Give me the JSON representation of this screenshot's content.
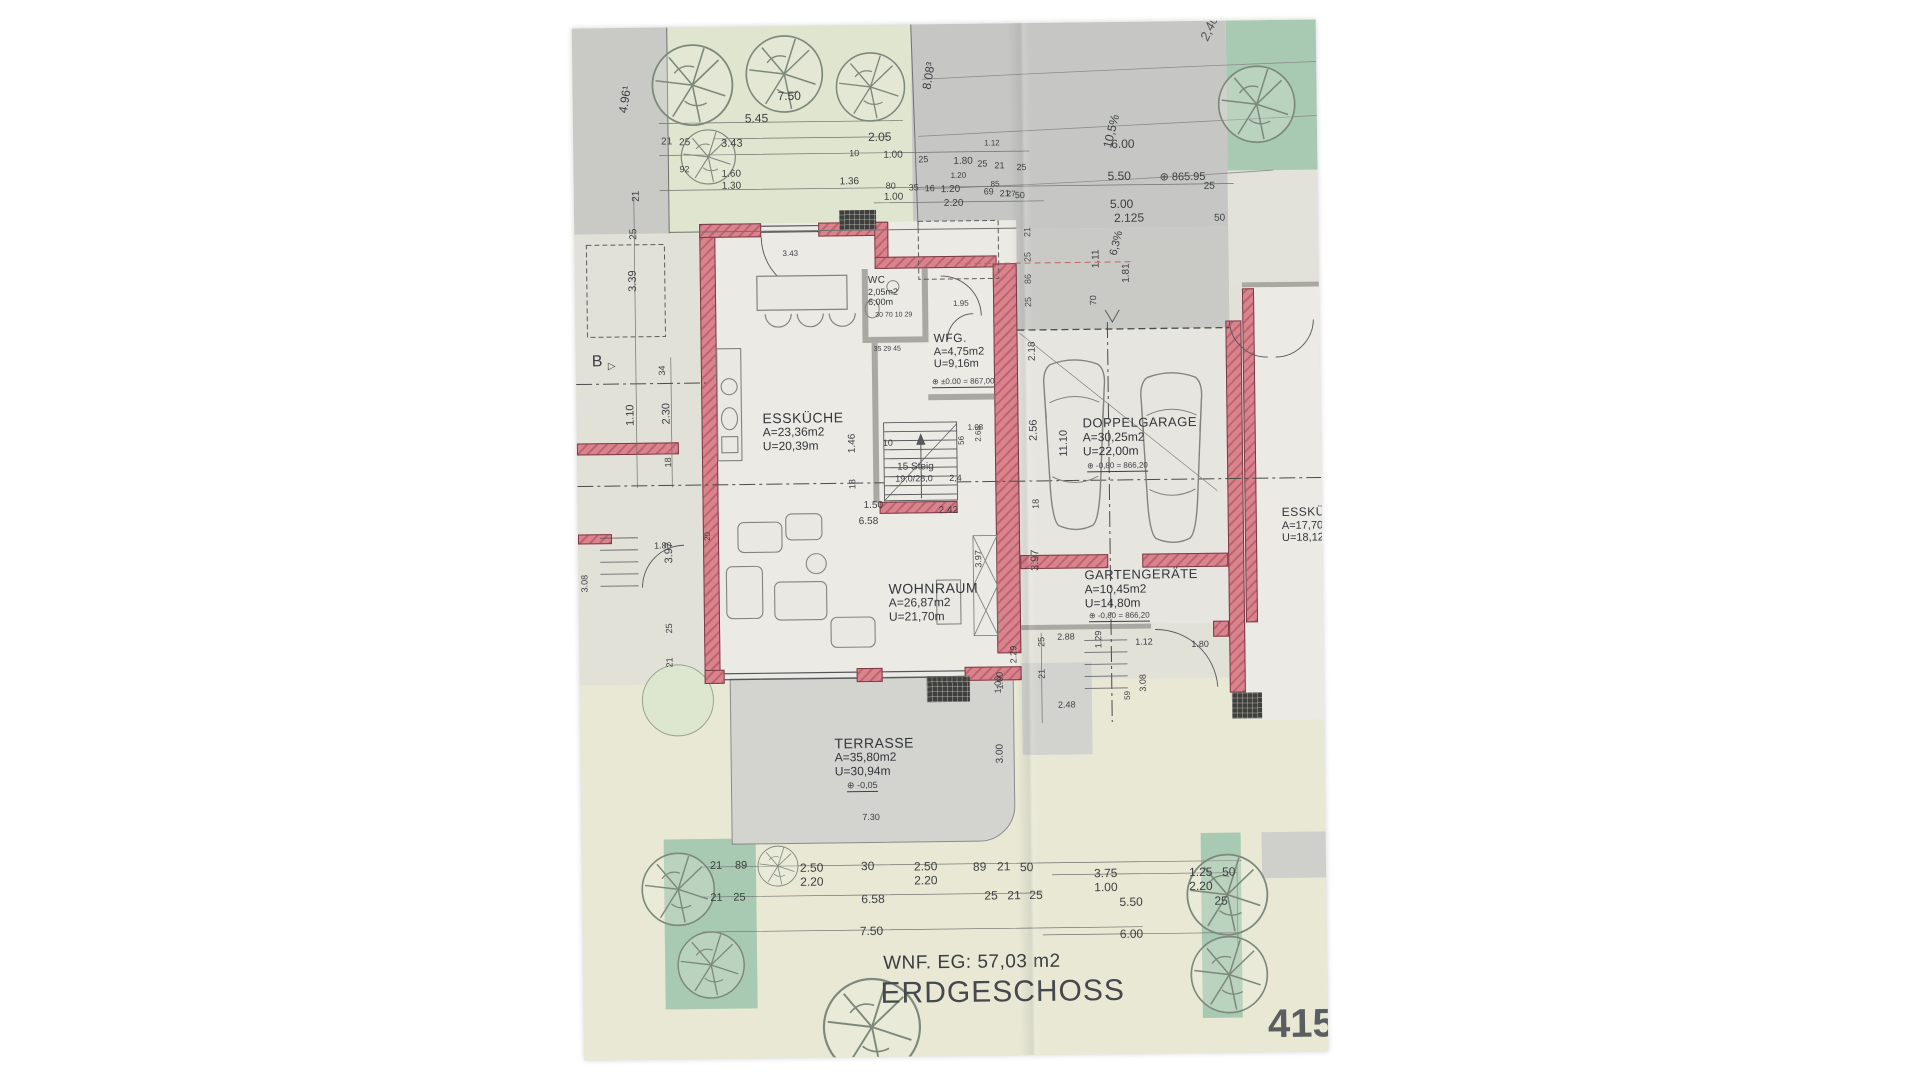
{
  "title_block": {
    "wnf": "WNF. EG: 57,03 m2",
    "floor": "ERDGESCHOSS",
    "sheet": "415"
  },
  "colors": {
    "wall_pink": "#d9838d",
    "paper": "#e2e1d8",
    "street_gray": "#c6c7c5",
    "garden_green": "#e0e5cf",
    "hedge_green": "#a8cab2",
    "terrace_gray": "#d3d3d0",
    "ink": "#3d4043"
  },
  "rooms": [
    {
      "id": "wc",
      "x": 293,
      "y": 250,
      "t": "WC",
      "ts": 10,
      "lines": [
        "2,05m2",
        "6,00m"
      ],
      "ls": 9
    },
    {
      "id": "wfg",
      "x": 358,
      "y": 308,
      "t": "WFG.",
      "ts": 12,
      "lines": [
        "A=4,75m2",
        "U=9,16m"
      ],
      "ls": 11
    },
    {
      "id": "esskueche",
      "x": 186,
      "y": 384,
      "t": "ESSKÜCHE",
      "ts": 14,
      "lines": [
        "A=23,36m2",
        "U=20,39m"
      ],
      "ls": 12
    },
    {
      "id": "wohnraum",
      "x": 310,
      "y": 556,
      "t": "WOHNRAUM",
      "ts": 14,
      "lines": [
        "A=26,87m2",
        "U=21,70m"
      ],
      "ls": 12
    },
    {
      "id": "doppelgarage",
      "x": 506,
      "y": 394,
      "t": "DOPPELGARAGE",
      "ts": 13,
      "lines": [
        "A=30,25m2",
        "U=22,00m"
      ],
      "ls": 12
    },
    {
      "id": "gartengeraete",
      "x": 506,
      "y": 546,
      "t": "GARTENGERÄTE",
      "ts": 13,
      "lines": [
        "A=10,45m2",
        "U=14,80m"
      ],
      "ls": 12
    },
    {
      "id": "terrasse",
      "x": 254,
      "y": 710,
      "t": "TERRASSE",
      "ts": 14,
      "lines": [
        "A=35,80m2",
        "U=30,94m"
      ],
      "ls": 12
    },
    {
      "id": "esskueche-nachbar",
      "x": 704,
      "y": 486,
      "t": "ESSKÜCHE",
      "ts": 12,
      "lines": [
        "A=17,70m2",
        "U=18,12m"
      ],
      "ls": 11
    }
  ],
  "dims": [
    {
      "t": "4.96¹",
      "x": 44,
      "y": 84,
      "r": -80,
      "s": 12
    },
    {
      "t": "7.50",
      "x": 205,
      "y": 64,
      "s": 12
    },
    {
      "t": "5.45",
      "x": 172,
      "y": 86,
      "s": 12
    },
    {
      "t": "3.43",
      "x": 148,
      "y": 112,
      "s": 11
    },
    {
      "t": "21",
      "x": 88,
      "y": 110
    },
    {
      "t": "25",
      "x": 106,
      "y": 111
    },
    {
      "t": "2.05",
      "x": 295,
      "y": 106,
      "s": 12
    },
    {
      "t": "10",
      "x": 276,
      "y": 124,
      "s": 9
    },
    {
      "t": "1.00",
      "x": 310,
      "y": 126
    },
    {
      "t": "25",
      "x": 345,
      "y": 131,
      "s": 9
    },
    {
      "t": "1.80",
      "x": 380,
      "y": 133
    },
    {
      "t": "25",
      "x": 404,
      "y": 136,
      "s": 9
    },
    {
      "t": "21",
      "x": 421,
      "y": 138,
      "s": 9
    },
    {
      "t": "25",
      "x": 443,
      "y": 140,
      "s": 9
    },
    {
      "t": "92",
      "x": 106,
      "y": 138,
      "s": 9
    },
    {
      "t": "1.60",
      "x": 148,
      "y": 143
    },
    {
      "t": "1.30",
      "x": 148,
      "y": 155
    },
    {
      "t": "1.36",
      "x": 266,
      "y": 152
    },
    {
      "t": "80",
      "x": 312,
      "y": 157,
      "s": 9
    },
    {
      "t": "35",
      "x": 335,
      "y": 159,
      "s": 9
    },
    {
      "t": "16",
      "x": 351,
      "y": 160,
      "s": 9
    },
    {
      "t": "1.20",
      "x": 367,
      "y": 161
    },
    {
      "t": "69",
      "x": 410,
      "y": 164,
      "s": 9
    },
    {
      "t": "21",
      "x": 426,
      "y": 166,
      "s": 9
    },
    {
      "t": "50",
      "x": 441,
      "y": 168,
      "s": 9
    },
    {
      "t": "1.00",
      "x": 310,
      "y": 168
    },
    {
      "t": "2.20",
      "x": 370,
      "y": 175
    },
    {
      "t": "6.00",
      "x": 538,
      "y": 116,
      "s": 12
    },
    {
      "t": "5.50",
      "x": 534,
      "y": 148,
      "s": 12
    },
    {
      "t": "⊕ 865.95",
      "x": 586,
      "y": 151,
      "s": 11
    },
    {
      "t": "25",
      "x": 630,
      "y": 161
    },
    {
      "t": "5.00",
      "x": 536,
      "y": 176,
      "s": 12
    },
    {
      "t": "2.125",
      "x": 540,
      "y": 190,
      "s": 12
    },
    {
      "t": "50",
      "x": 640,
      "y": 193
    },
    {
      "t": "10,5%",
      "x": 528,
      "y": 124,
      "r": -75,
      "s": 12
    },
    {
      "t": "8.08³",
      "x": 348,
      "y": 64,
      "r": -80,
      "s": 12
    },
    {
      "t": "2,40",
      "x": 626,
      "y": 16,
      "r": -65,
      "s": 13,
      "i": 1
    },
    {
      "t": "21",
      "x": 58,
      "y": 174,
      "r": -90
    },
    {
      "t": "25",
      "x": 55,
      "y": 212,
      "r": -90
    },
    {
      "t": "3.39",
      "x": 53,
      "y": 264,
      "r": -90,
      "s": 11
    },
    {
      "t": "B",
      "x": 16,
      "y": 326,
      "s": 16
    },
    {
      "t": "▷",
      "x": 32,
      "y": 334,
      "s": 10
    },
    {
      "t": "34",
      "x": 82,
      "y": 348,
      "r": -90,
      "s": 9
    },
    {
      "t": "1.10",
      "x": 49,
      "y": 398,
      "r": -90,
      "s": 11
    },
    {
      "t": "2.30",
      "x": 85,
      "y": 397,
      "r": -90,
      "s": 11
    },
    {
      "t": "18",
      "x": 87,
      "y": 440,
      "r": -90,
      "s": 9
    },
    {
      "t": "21",
      "x": 449,
      "y": 214,
      "r": -90,
      "s": 9
    },
    {
      "t": "25",
      "x": 449,
      "y": 239,
      "r": -90,
      "s": 9
    },
    {
      "t": "86",
      "x": 449,
      "y": 261,
      "r": -90,
      "s": 9
    },
    {
      "t": "25",
      "x": 449,
      "y": 284,
      "r": -90,
      "s": 9
    },
    {
      "t": "70",
      "x": 514,
      "y": 283,
      "r": -90,
      "s": 9
    },
    {
      "t": "1.11",
      "x": 517,
      "y": 246,
      "r": -90
    },
    {
      "t": "1.81",
      "x": 547,
      "y": 261,
      "r": -90
    },
    {
      "t": "6,3%",
      "x": 534,
      "y": 232,
      "r": -75,
      "s": 11
    },
    {
      "t": "1.12",
      "x": 411,
      "y": 116,
      "s": 8
    },
    {
      "t": "1.20",
      "x": 377,
      "y": 148,
      "s": 8
    },
    {
      "t": "85",
      "x": 417,
      "y": 157,
      "s": 8
    },
    {
      "t": "27",
      "x": 433,
      "y": 167,
      "s": 8
    },
    {
      "t": "2.18",
      "x": 452,
      "y": 338,
      "r": -90
    },
    {
      "t": "1.95",
      "x": 378,
      "y": 276,
      "s": 8
    },
    {
      "t": "3.43",
      "x": 208,
      "y": 224,
      "s": 8
    },
    {
      "t": "30 70 10 29",
      "x": 300,
      "y": 287,
      "s": 7
    },
    {
      "t": "35 29 45",
      "x": 298,
      "y": 321,
      "s": 7
    },
    {
      "t": "⊕ ±0.00 = 867,00",
      "x": 356,
      "y": 354,
      "s": 8,
      "u": 1
    },
    {
      "t": "1.46",
      "x": 271,
      "y": 428,
      "r": -90
    },
    {
      "t": "10",
      "x": 306,
      "y": 414,
      "s": 9
    },
    {
      "t": "1.08",
      "x": 391,
      "y": 400,
      "s": 8
    },
    {
      "t": "56",
      "x": 381,
      "y": 421,
      "r": -90,
      "s": 8
    },
    {
      "t": "2.68",
      "x": 398,
      "y": 418,
      "r": -90,
      "s": 8
    },
    {
      "t": "15 Steig",
      "x": 320,
      "y": 438,
      "s": 10
    },
    {
      "t": "19,0/28,0",
      "x": 318,
      "y": 450,
      "s": 9
    },
    {
      "t": "2,4",
      "x": 372,
      "y": 450,
      "s": 9
    },
    {
      "t": "18",
      "x": 271,
      "y": 464,
      "r": -90,
      "s": 9
    },
    {
      "t": "1.50",
      "x": 286,
      "y": 476
    },
    {
      "t": "2.42",
      "x": 361,
      "y": 482
    },
    {
      "t": "6.58",
      "x": 281,
      "y": 492
    },
    {
      "t": "2.56",
      "x": 452,
      "y": 418,
      "r": -90,
      "s": 11
    },
    {
      "t": "11.10",
      "x": 482,
      "y": 434,
      "r": -90,
      "s": 11
    },
    {
      "t": "18",
      "x": 454,
      "y": 486,
      "r": -90,
      "s": 9
    },
    {
      "t": "3.97",
      "x": 452,
      "y": 548,
      "r": -90,
      "s": 11
    },
    {
      "t": "3.97",
      "x": 396,
      "y": 544,
      "r": -90,
      "s": 9
    },
    {
      "t": "⊕ -0,80 = 866,20",
      "x": 510,
      "y": 440,
      "s": 8,
      "u": 1
    },
    {
      "t": "⊕ -0,80 = 866,20",
      "x": 510,
      "y": 590,
      "s": 8,
      "u": 1
    },
    {
      "t": "2.88",
      "x": 478,
      "y": 610,
      "s": 9
    },
    {
      "t": "25",
      "x": 458,
      "y": 624,
      "r": -90,
      "s": 9
    },
    {
      "t": "21",
      "x": 458,
      "y": 656,
      "r": -90,
      "s": 9
    },
    {
      "t": "2.29",
      "x": 430,
      "y": 640,
      "r": -90,
      "s": 9
    },
    {
      "t": "1.00",
      "x": 416,
      "y": 666,
      "r": -90,
      "s": 9
    },
    {
      "t": "2.48",
      "x": 478,
      "y": 678,
      "s": 9
    },
    {
      "t": "1.29",
      "x": 515,
      "y": 626,
      "r": -90,
      "s": 9
    },
    {
      "t": "1.12",
      "x": 556,
      "y": 616,
      "s": 9
    },
    {
      "t": "1.80",
      "x": 612,
      "y": 619,
      "s": 9
    },
    {
      "t": "59",
      "x": 544,
      "y": 678,
      "r": -90,
      "s": 8
    },
    {
      "t": "3.08",
      "x": 559,
      "y": 670,
      "r": -90,
      "s": 9
    },
    {
      "t": "1.80",
      "x": 76,
      "y": 514,
      "s": 9
    },
    {
      "t": "3.97",
      "x": 86,
      "y": 536,
      "r": -90,
      "s": 11
    },
    {
      "t": "20",
      "x": 126,
      "y": 514,
      "r": -90,
      "s": 8
    },
    {
      "t": "25",
      "x": 86,
      "y": 606,
      "r": -90,
      "s": 9
    },
    {
      "t": "21",
      "x": 86,
      "y": 640,
      "r": -90,
      "s": 9
    },
    {
      "t": "3.08",
      "x": 2,
      "y": 564,
      "r": -90,
      "s": 9
    },
    {
      "t": "1.00",
      "x": 414,
      "y": 670,
      "r": -90,
      "s": 9
    },
    {
      "t": "3.00",
      "x": 415,
      "y": 740,
      "r": -90,
      "s": 10
    },
    {
      "t": "7.30",
      "x": 281,
      "y": 788,
      "s": 9
    },
    {
      "t": "⊕ -0,05",
      "x": 266,
      "y": 756,
      "s": 9,
      "u": 1
    },
    {
      "t": "21",
      "x": 128,
      "y": 834,
      "s": 11
    },
    {
      "t": "89",
      "x": 153,
      "y": 834,
      "s": 11
    },
    {
      "t": "2.50",
      "x": 218,
      "y": 836,
      "s": 12
    },
    {
      "t": "2.20",
      "x": 218,
      "y": 850,
      "s": 12
    },
    {
      "t": "30",
      "x": 279,
      "y": 835,
      "s": 12
    },
    {
      "t": "2.50",
      "x": 332,
      "y": 836,
      "s": 12
    },
    {
      "t": "2.20",
      "x": 332,
      "y": 850,
      "s": 12
    },
    {
      "t": "89",
      "x": 391,
      "y": 837,
      "s": 12
    },
    {
      "t": "21",
      "x": 415,
      "y": 837,
      "s": 12
    },
    {
      "t": "50",
      "x": 438,
      "y": 838,
      "s": 12
    },
    {
      "t": "21",
      "x": 128,
      "y": 866,
      "s": 11
    },
    {
      "t": "25",
      "x": 151,
      "y": 866,
      "s": 11
    },
    {
      "t": "6.58",
      "x": 279,
      "y": 868,
      "s": 12
    },
    {
      "t": "25",
      "x": 402,
      "y": 866,
      "s": 12
    },
    {
      "t": "21",
      "x": 425,
      "y": 866,
      "s": 12
    },
    {
      "t": "25",
      "x": 447,
      "y": 866,
      "s": 12
    },
    {
      "t": "7.50",
      "x": 277,
      "y": 900,
      "s": 12
    },
    {
      "t": "3.75",
      "x": 512,
      "y": 845,
      "s": 12
    },
    {
      "t": "1.00",
      "x": 512,
      "y": 859,
      "s": 12
    },
    {
      "t": "1.25",
      "x": 607,
      "y": 845,
      "s": 12
    },
    {
      "t": "2.20",
      "x": 607,
      "y": 859,
      "s": 12
    },
    {
      "t": "50",
      "x": 640,
      "y": 845,
      "s": 12
    },
    {
      "t": "5.50",
      "x": 537,
      "y": 874,
      "s": 12
    },
    {
      "t": "25",
      "x": 632,
      "y": 874,
      "s": 12
    },
    {
      "t": "6.00",
      "x": 537,
      "y": 906,
      "s": 12
    }
  ]
}
